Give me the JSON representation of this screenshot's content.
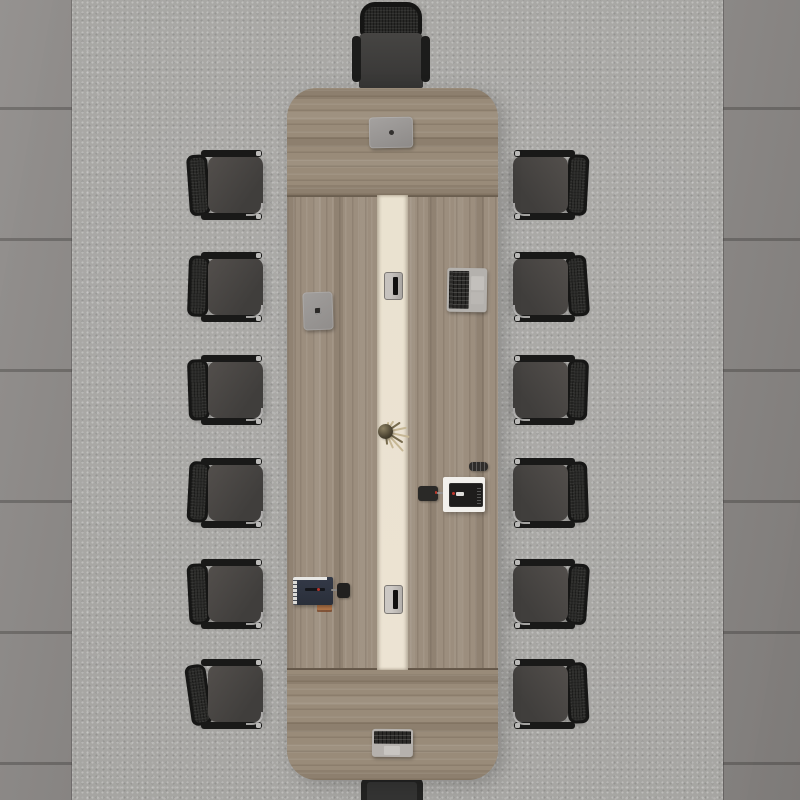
{
  "scene": {
    "title": "Top-down view of a conference room",
    "aria_label": "Overhead view of a long wooden conference table with fourteen black office chairs on a gray speckled carpet between dark concrete wall panels",
    "room": {
      "floor": "light gray speckled carpet",
      "side_panels": "dark gray concrete tile panels with horizontal seams on left and right edges"
    },
    "table": {
      "material": "gray-brown walnut wood",
      "shape": "long rounded rectangle, vertical orientation",
      "runner": "cream center accent stripe with two recessed cable hatches",
      "sections": "horizontal-grain end panels top and bottom, vertical-grain main surface"
    },
    "chairs": {
      "total": 14,
      "left_side": 6,
      "right_side": 6,
      "head_top": 1,
      "head_bottom_partial": 1,
      "style": "black mesh-back office chairs with dark gray seats, black armrests and chrome accents"
    },
    "objects_on_table": [
      {
        "name": "closed-laptop",
        "desc": "closed gray laptop with dark logo at top center"
      },
      {
        "name": "cable-grommet-top",
        "desc": "recessed metal cable hatch in cream runner"
      },
      {
        "name": "gray-tablet",
        "desc": "gray tablet with dark logo on left side"
      },
      {
        "name": "open-laptop-side",
        "desc": "open silver laptop turned toward right-side seat"
      },
      {
        "name": "dried-plant",
        "desc": "small round vase with dried twigs on runner"
      },
      {
        "name": "power-adapter",
        "desc": "black square adapter with cable to dark tablet"
      },
      {
        "name": "coffee-cup",
        "desc": "dark cup seen from above"
      },
      {
        "name": "white-notepad",
        "desc": "white notepad holding a black tablet with stylus"
      },
      {
        "name": "navy-notebook",
        "desc": "dark navy notebook with pen and orange sticky notes"
      },
      {
        "name": "black-pouch",
        "desc": "small black pouch beside the notebook"
      },
      {
        "name": "cable-grommet-bottom",
        "desc": "second recessed cable hatch in runner"
      },
      {
        "name": "open-laptop-bottom",
        "desc": "open silver laptop at bottom end of table"
      }
    ],
    "palette": {
      "carpet": "#a6a5a2",
      "panel_left": "#8f8c8a",
      "panel_right": "#858280",
      "wood": "#9c8e7e",
      "wood_streak": "#7c6f5f",
      "runner": "#eae2d1",
      "chair_seat": "#4a4947",
      "chair_frame": "#161615",
      "laptop_silver": "#b5b2ae",
      "notepad": "#f2f0ec",
      "notebook_navy": "#303540",
      "sticky_orange": "#b07448",
      "accent_red": "#c4372e"
    }
  }
}
